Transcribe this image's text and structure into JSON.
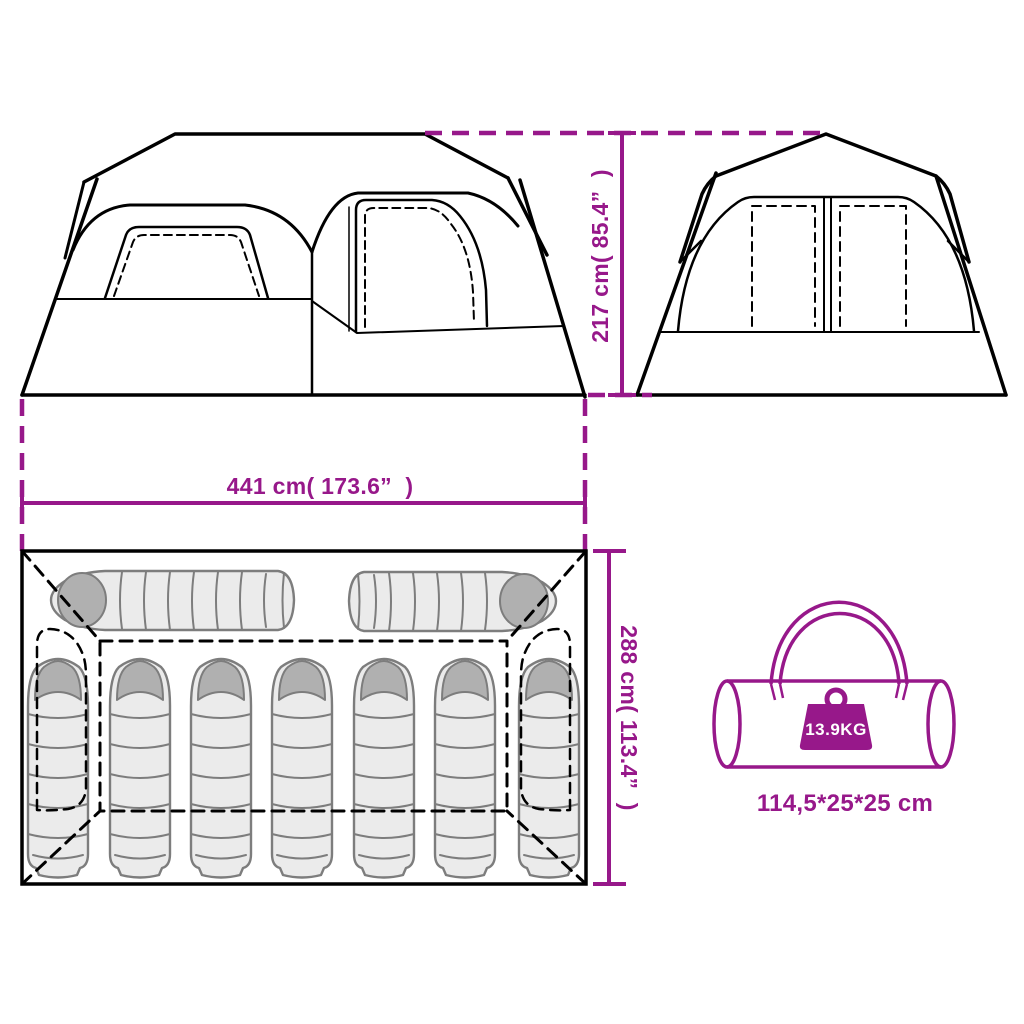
{
  "colors": {
    "accent_purple": "#97188A",
    "line_black": "#000000",
    "sleeping_bag_fill": "#ebebeb",
    "sleeping_bag_stroke": "#7d7d7d",
    "sleeping_bag_hood": "#b0b0b0",
    "background": "#ffffff"
  },
  "labels": {
    "height": "217 cm( 85.4”  )",
    "width": "441 cm( 173.6”  )",
    "depth": "288 cm( 113.4”  )",
    "weight": "13.9KG",
    "packed_size": "114,5*25*25 cm"
  },
  "views": {
    "front_view": "tent front elevation with two windows",
    "side_view": "tent side elevation with split window",
    "floor_plan": {
      "sleeping_bags_horizontal": 2,
      "sleeping_bags_vertical": 7,
      "sleeping_capacity": 9
    },
    "packed_view": "carry bag with weight badge"
  }
}
